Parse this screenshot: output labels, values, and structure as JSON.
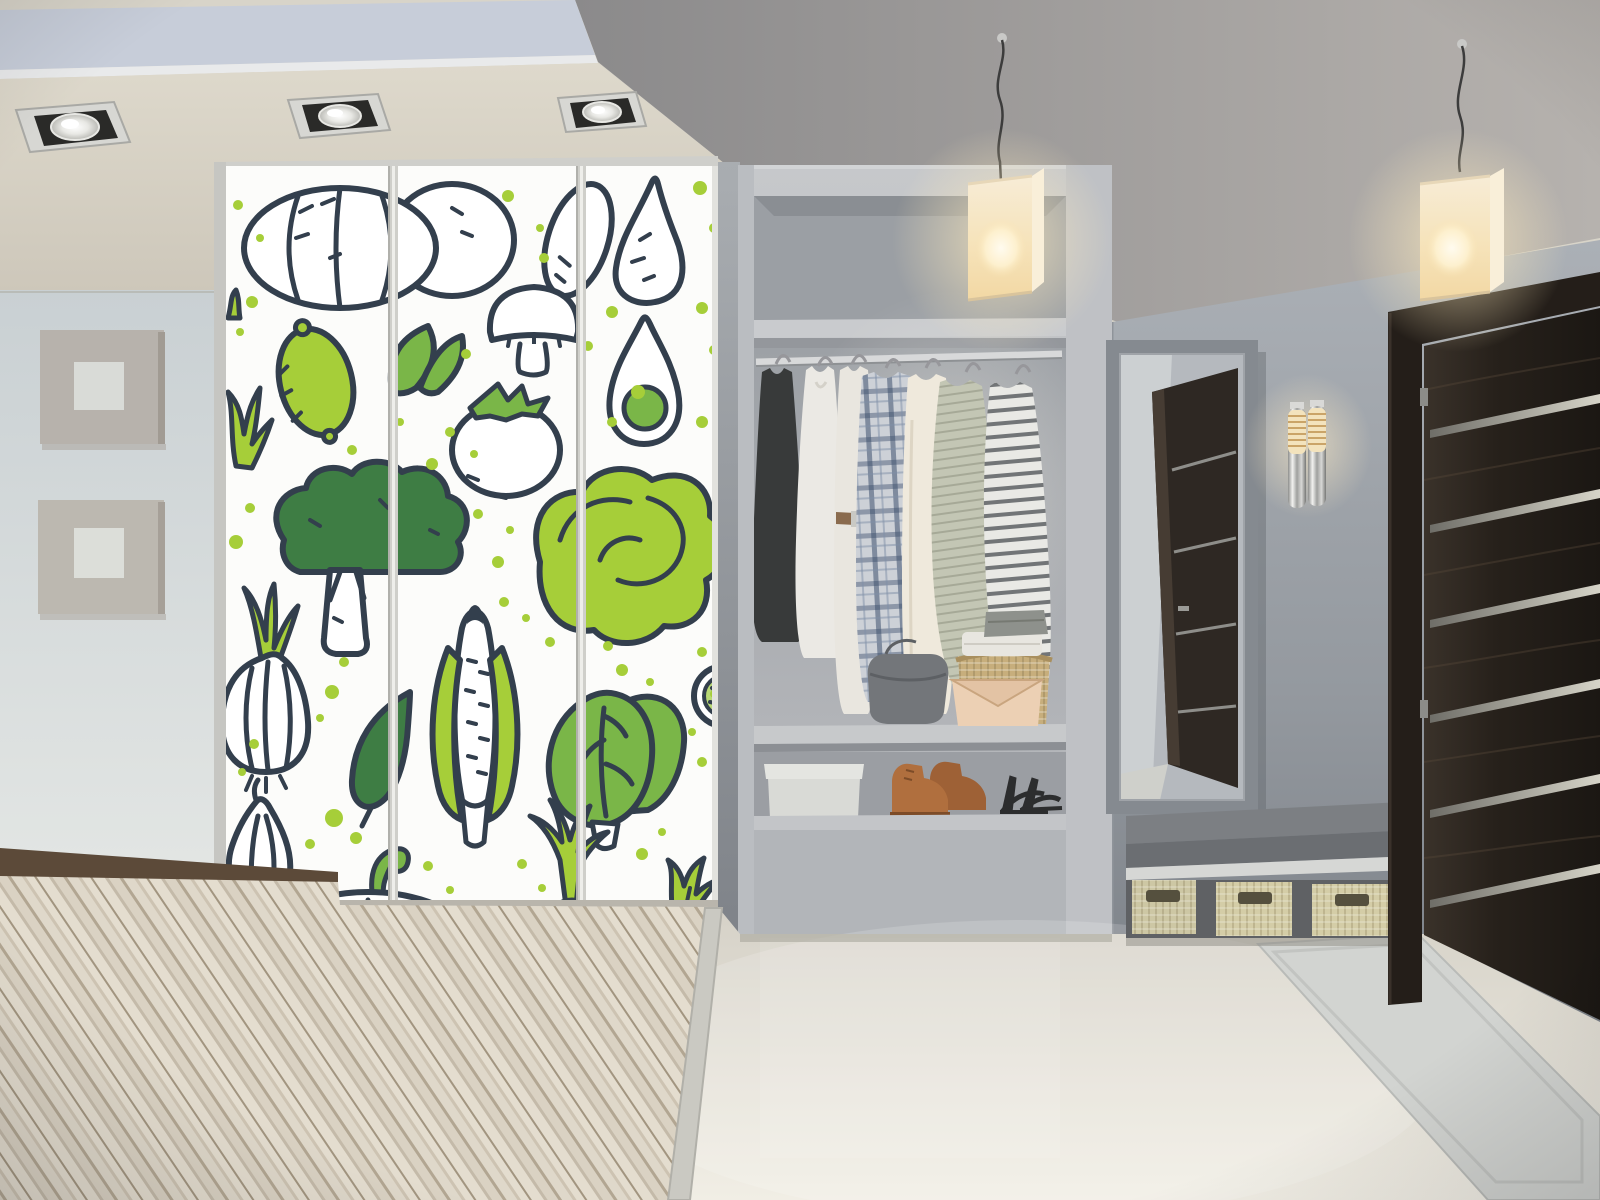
{
  "scene": {
    "description": "Modern hallway interior: wardrobe with green vegetable doodle decal, open closet niche with clothes and shoes, cube pendant lamps, framed mirror reflecting a dark wooden door, chrome wall sconce, dark wenge entrance door with metal strips, bench with wicker baskets, diagonal wood flooring and glossy tile",
    "room": "hallway"
  },
  "colors": {
    "accent_green": "#a6ce39",
    "mid_green": "#7ab648",
    "dark_green": "#3e7d44",
    "outline_navy": "#333f4d",
    "wardrobe_white": "#fcfcfa",
    "wall_left": "#ccd3d5",
    "wall_right": "#959aa1",
    "ceiling_cream": "#d8d3c6",
    "ceiling_recess": "#c7cdd9",
    "closet_gray": "#b9bcc0",
    "niche_gray": "#a4a8ad",
    "door_brown": "#241e19",
    "lamp_glow": "#f6e3b6",
    "floor_tile": "#e9e5da",
    "wood_light": "#efe9dc",
    "wood_dark": "#b9ad99",
    "wood_border": "#5c4a39",
    "bench_gray": "#6b6e72",
    "basket_tan": "#d4cda7",
    "clutch_beige": "#ecd0b4",
    "handbag_gray": "#73767a",
    "boots_brown": "#b06f3e",
    "mat_gray": "#d2d4d1"
  },
  "wardrobe": {
    "panels": 3,
    "pattern_items": [
      "pumpkin",
      "squash",
      "pear",
      "mushroom",
      "lime",
      "leaf-pair",
      "tomato",
      "avocado-half",
      "herb-sprigs",
      "broccoli",
      "lettuce",
      "onion",
      "leaf",
      "corn",
      "bok-choy",
      "cucumber-slice",
      "garlic",
      "pumpkin-bottom",
      "scallion",
      "herb-tuft",
      "green-dots"
    ]
  },
  "closet": {
    "hanging_items": [
      "black-dress",
      "white-sleeveless-dress",
      "white-shirt-with-belt",
      "blue-plaid-shirt",
      "cream-long-sleeve-top",
      "sage-knit-sweater",
      "striped-knit-top"
    ],
    "shelf_items": [
      "gray-handbag",
      "folded-textiles",
      "wicker-basket",
      "beige-envelope-clutch"
    ],
    "floor_items": [
      "white-storage-box",
      "brown-leather-boots",
      "black-strappy-heels"
    ]
  },
  "lighting": {
    "recessed_spotlights": 3,
    "pendant_lamps": 2,
    "wall_sconce_tubes": 2
  },
  "door": {
    "material": "dark wenge wood",
    "metal_strips": 6,
    "hinges": 2
  },
  "mirror": {
    "reflection": "dark wooden door"
  },
  "bench": {
    "baskets": 3
  },
  "wall_decor": {
    "square_panels": 2
  }
}
